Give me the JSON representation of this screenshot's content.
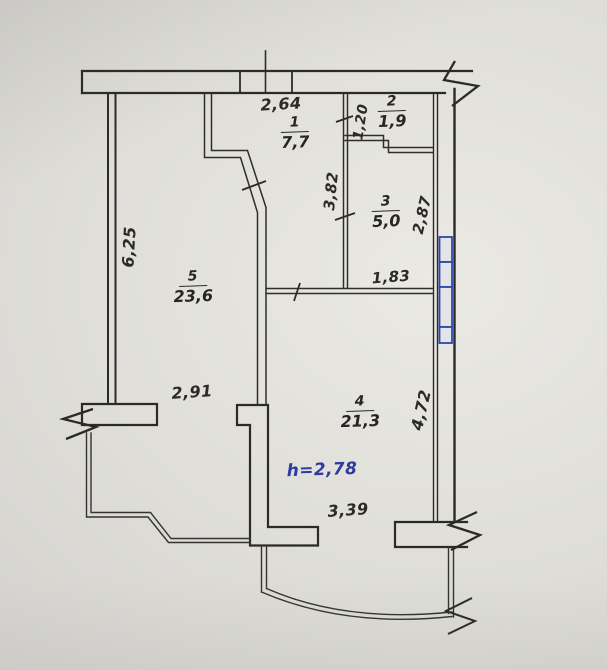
{
  "plan": {
    "rooms": {
      "r1": {
        "num": "1",
        "area": "7,7"
      },
      "r2": {
        "num": "2",
        "area": "1,9"
      },
      "r3": {
        "num": "3",
        "area": "5,0"
      },
      "r4": {
        "num": "4",
        "area": "21,3"
      },
      "r5": {
        "num": "5",
        "area": "23,6"
      }
    },
    "dims": {
      "d264": "2,64",
      "d120": "1,20",
      "d382": "3,82",
      "d287": "2,87",
      "d183": "1,83",
      "d625": "6,25",
      "d291": "2,91",
      "d472": "4,72",
      "d339": "3,39"
    },
    "notes": {
      "ceiling_height": "h=2,78"
    },
    "colors": {
      "ink": "#2b2a26",
      "window_blue": "#2e46b0",
      "note_blue": "#2c3c9e",
      "paper": "#dddcd7"
    }
  }
}
